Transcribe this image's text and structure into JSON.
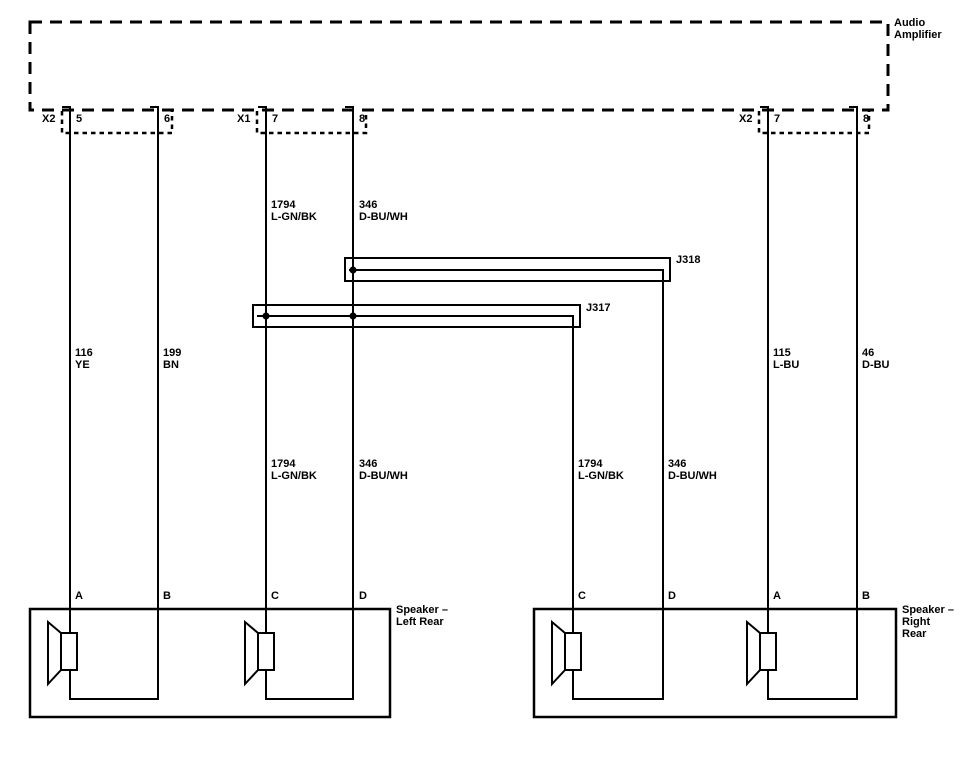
{
  "colors": {
    "line": "#000000",
    "background": "#ffffff"
  },
  "amplifier": {
    "lines": [
      "Audio",
      "Amplifier"
    ]
  },
  "connectors": [
    {
      "name": "X2",
      "pin_a": "5",
      "pin_b": "6"
    },
    {
      "name": "X1",
      "pin_a": "7",
      "pin_b": "8"
    },
    {
      "name": "X2",
      "pin_a": "7",
      "pin_b": "8"
    }
  ],
  "splices": {
    "j318": "J318",
    "j317": "J317"
  },
  "wire_labels": [
    {
      "circuit": "116",
      "color": "YE"
    },
    {
      "circuit": "199",
      "color": "BN"
    },
    {
      "circuit": "1794",
      "color": "L-GN/BK"
    },
    {
      "circuit": "346",
      "color": "D-BU/WH"
    },
    {
      "circuit": "1794",
      "color": "L-GN/BK"
    },
    {
      "circuit": "346",
      "color": "D-BU/WH"
    },
    {
      "circuit": "1794",
      "color": "L-GN/BK"
    },
    {
      "circuit": "346",
      "color": "D-BU/WH"
    },
    {
      "circuit": "115",
      "color": "L-BU"
    },
    {
      "circuit": "46",
      "color": "D-BU"
    }
  ],
  "speakers": [
    {
      "lines": [
        "Speaker –",
        "Left Rear",
        ""
      ],
      "pins": [
        "A",
        "B",
        "C",
        "D"
      ]
    },
    {
      "lines": [
        "Speaker –",
        "Right",
        "Rear"
      ],
      "pins": [
        "C",
        "D",
        "A",
        "B"
      ]
    }
  ]
}
